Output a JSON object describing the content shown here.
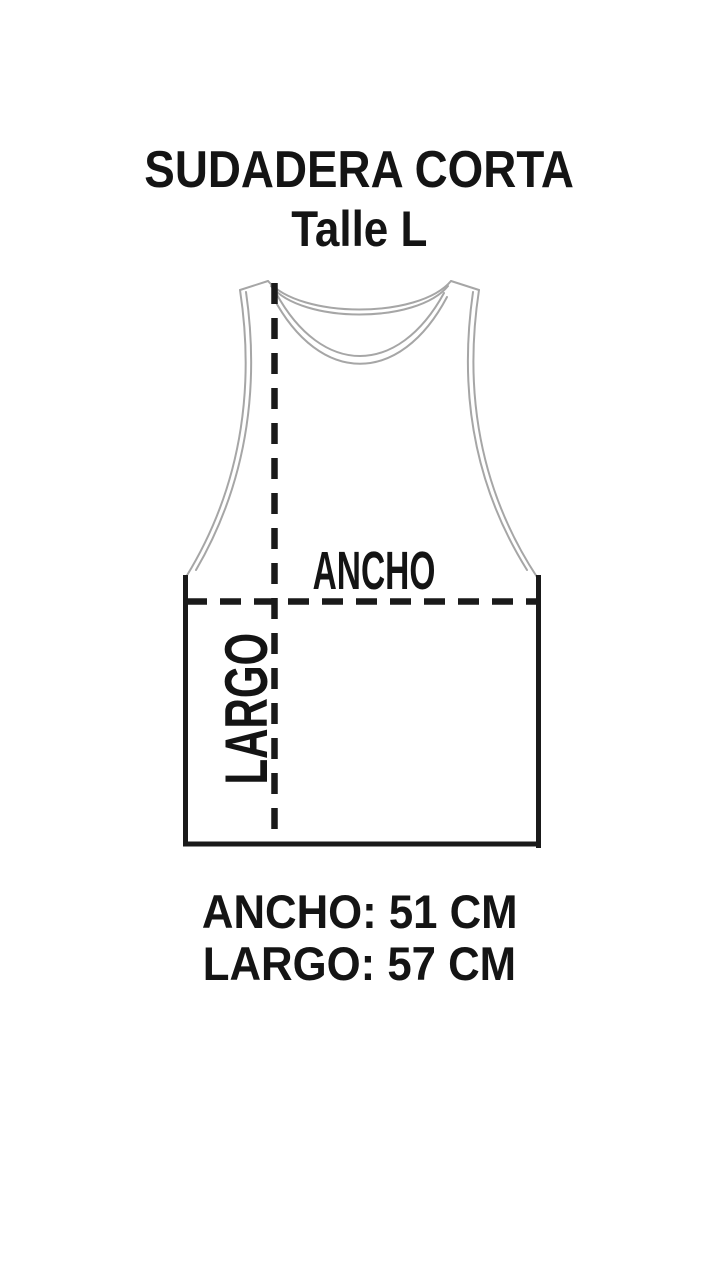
{
  "header": {
    "title": "SUDADERA CORTA",
    "subtitle": "Talle L"
  },
  "diagram": {
    "garment": "sleeveless-tank-top-outline",
    "width_label": "ANCHO",
    "length_label": "LARGO"
  },
  "measurements": {
    "width_line": "ANCHO: 51 CM",
    "length_line": "LARGO: 57 CM",
    "width_cm": 51,
    "length_cm": 57,
    "unit": "CM"
  },
  "colors": {
    "background": "#ffffff",
    "text": "#141414",
    "outline": "#a6a6a6",
    "dimension_lines": "#1a1a1a"
  }
}
